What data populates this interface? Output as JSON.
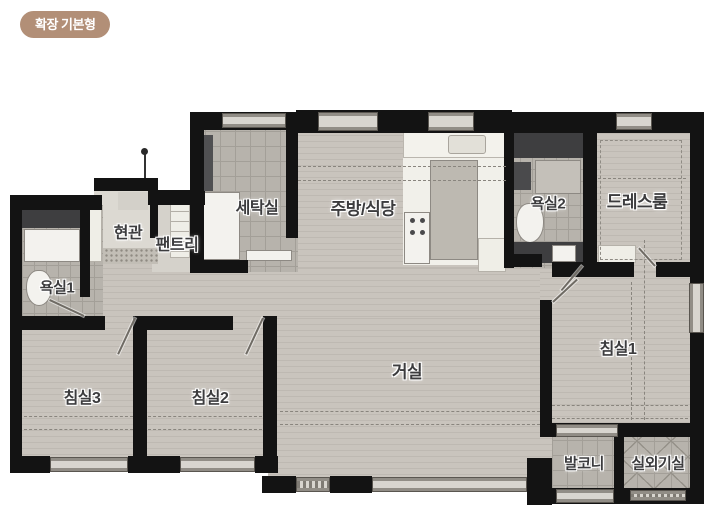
{
  "badge": {
    "label": "확장 기본형"
  },
  "floorplan": {
    "rooms": [
      {
        "id": "entrance",
        "label": "현관"
      },
      {
        "id": "pantry",
        "label": "팬트리"
      },
      {
        "id": "laundry",
        "label": "세탁실"
      },
      {
        "id": "kitchen_dining",
        "label": "주방/식당"
      },
      {
        "id": "bathroom2",
        "label": "욕실2"
      },
      {
        "id": "dressroom",
        "label": "드레스룸"
      },
      {
        "id": "bathroom1",
        "label": "욕실1"
      },
      {
        "id": "living",
        "label": "거실"
      },
      {
        "id": "bedroom1",
        "label": "침실1"
      },
      {
        "id": "bedroom2",
        "label": "침실2"
      },
      {
        "id": "bedroom3",
        "label": "침실3"
      },
      {
        "id": "balcony",
        "label": "발코니"
      },
      {
        "id": "outdoor_unit",
        "label": "실외기실"
      }
    ]
  },
  "colors": {
    "badge_bg": "#b28f77",
    "badge_text": "#ffffff",
    "wall": "#131313",
    "floor_main": "#c9c4bd",
    "floor_tile": "#b7b3ac",
    "kitchen_white": "#f1f0ea",
    "fixture_dark": "#3e3e40",
    "fixture_white": "#f3f2ee",
    "label_color": "#3c3c3e",
    "bg": "#ffffff"
  }
}
